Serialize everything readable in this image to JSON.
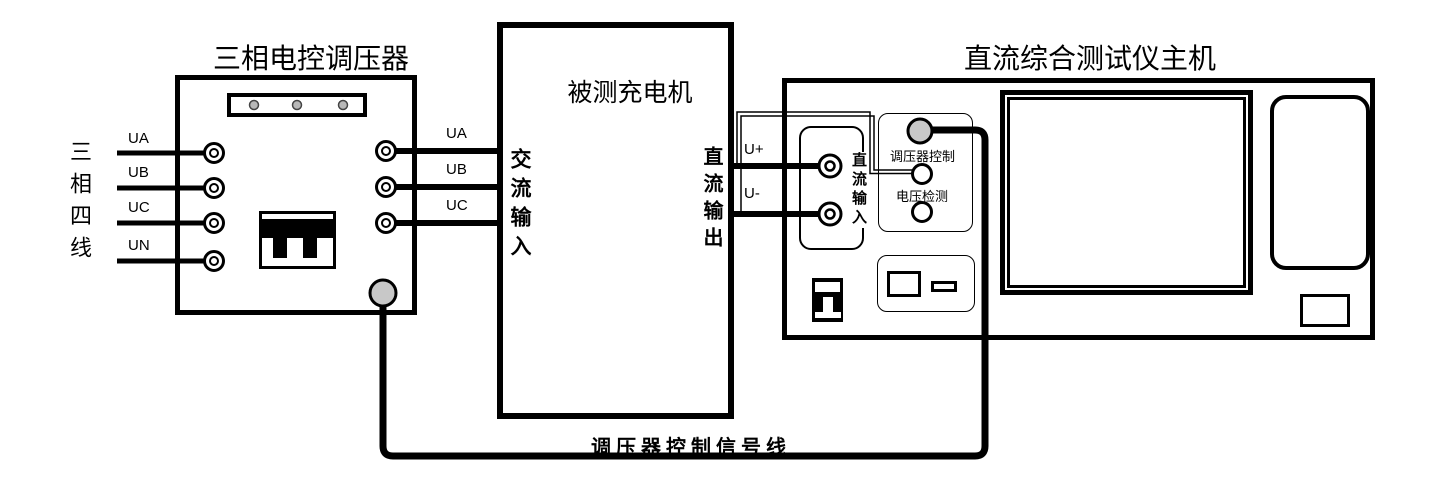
{
  "diagram": {
    "regulator": {
      "title": "三相电控调压器",
      "phase_label": "三相四线",
      "input_terminals": [
        "UA",
        "UB",
        "UC",
        "UN"
      ],
      "output_wires": [
        "UA",
        "UB",
        "UC"
      ]
    },
    "charger": {
      "title": "被测充电机",
      "ac_input_label": "交流输入",
      "dc_output_label": "直流输出"
    },
    "tester": {
      "title": "直流综合测试仪主机",
      "dc_input_label": "直流输入",
      "regulator_control_label": "调压器控制",
      "voltage_detect_label": "电压检测"
    },
    "wires": {
      "u_plus": "U+",
      "u_minus": "U-",
      "control_signal": "调压器控制信号线"
    },
    "colors": {
      "connector_gray": "#c8c8c8",
      "line": "#000000"
    }
  }
}
